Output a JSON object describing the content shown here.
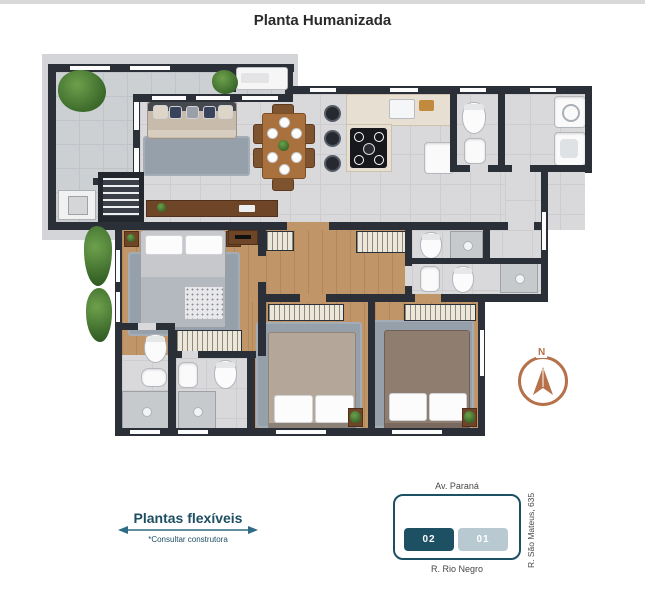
{
  "page": {
    "title": "Planta Humanizada"
  },
  "legend": {
    "label": "Plantas flexíveis",
    "note": "*Consultar construtora"
  },
  "location_map": {
    "street_top": "Av. Paraná",
    "street_bottom": "R. Rio Negro",
    "street_right": "R. São Mateus, 635",
    "unit_highlighted": "02",
    "unit_other": "01"
  },
  "compass": {
    "north_label": "N"
  },
  "colors": {
    "wall": "#2b2f37",
    "tile_floor": "#d9d9db",
    "terrace_tile": "#cdd0d3",
    "wood_floor": "#c09568",
    "rug": "#96a0ab",
    "slab": "#d3d5d9",
    "accent_teal": "#1e5064",
    "unit_other_fill": "#b9c9d2",
    "compass_copper": "#b5724a",
    "legend_text": "#1d4f63",
    "title_text": "#2a2a2a"
  }
}
